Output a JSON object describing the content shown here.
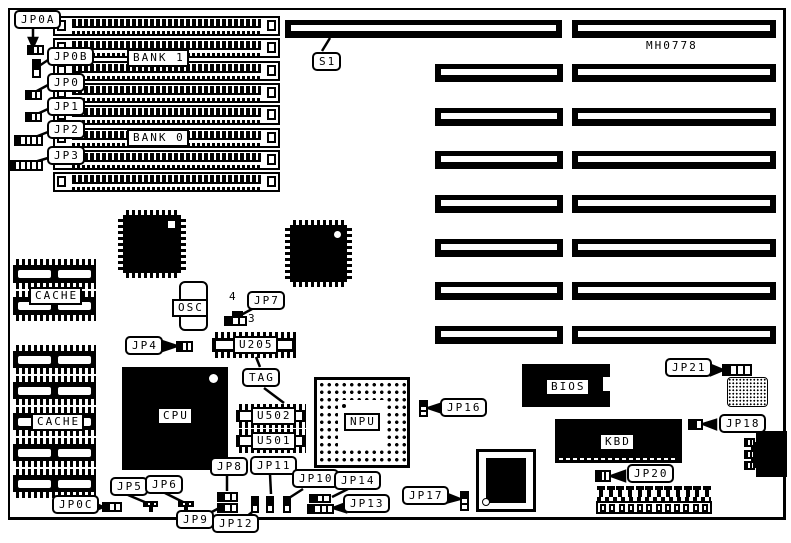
{
  "diagram": {
    "part_number": "MH0778",
    "memory_banks": {
      "bank1": "BANK 1",
      "bank0": "BANK 0"
    },
    "switch": {
      "s1": "S1"
    },
    "chips": {
      "cache_upper": "CACHE",
      "cache_lower": "CACHE",
      "osc": "OSC",
      "u205": "U205",
      "tag": "TAG",
      "cpu": "CPU",
      "u502": "U502",
      "u501": "U501",
      "npu": "NPU",
      "bios": "BIOS",
      "kbd": "KBD"
    },
    "jumpers": {
      "jp0a": "JP0A",
      "jp0b": "JP0B",
      "jp0": "JP0",
      "jp1": "JP1",
      "jp2": "JP2",
      "jp3": "JP3",
      "jp4": "JP4",
      "jp5": "JP5",
      "jp6": "JP6",
      "jp7": "JP7",
      "jp8": "JP8",
      "jp9": "JP9",
      "jp10": "JP10",
      "jp11": "JP11",
      "jp12": "JP12",
      "jp13": "JP13",
      "jp14": "JP14",
      "jp16": "JP16",
      "jp17": "JP17",
      "jp18": "JP18",
      "jp20": "JP20",
      "jp21": "JP21",
      "jp0c": "JP0C"
    },
    "pin_labels": {
      "jp7_pin4": "4",
      "jp7_pin3": "3"
    },
    "colors": {
      "ink": "#000000",
      "paper": "#ffffff"
    }
  }
}
